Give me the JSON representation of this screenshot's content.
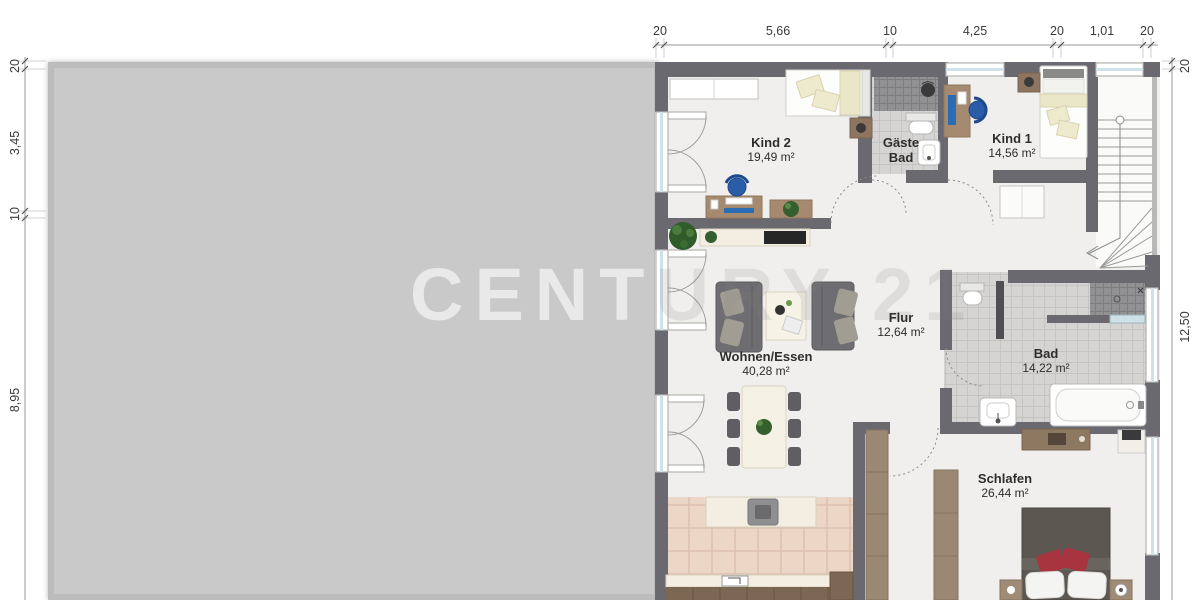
{
  "watermark": "CENTURY 21",
  "rooms": [
    {
      "id": "kind2",
      "name": "Kind 2",
      "area": "19,49 m²"
    },
    {
      "id": "gaeste-bad",
      "name": "Gäste Bad",
      "area": ""
    },
    {
      "id": "kind1",
      "name": "Kind 1",
      "area": "14,56 m²"
    },
    {
      "id": "flur",
      "name": "Flur",
      "area": "12,64 m²"
    },
    {
      "id": "wohnen-essen",
      "name": "Wohnen/Essen",
      "area": "40,28 m²"
    },
    {
      "id": "bad",
      "name": "Bad",
      "area": "14,22 m²"
    },
    {
      "id": "schlafen",
      "name": "Schlafen",
      "area": "26,44 m²"
    }
  ],
  "dimensions": {
    "top": [
      "20",
      "5,66",
      "10",
      "4,25",
      "20",
      "1,01",
      "20"
    ],
    "left": [
      "20",
      "3,45",
      "10",
      "8,95"
    ],
    "right": [
      "20",
      "12,50"
    ]
  },
  "colors": {
    "wall": "#6b6970",
    "floor": "#f0efed",
    "tile": "#d6d4d2",
    "tileDark": "#919193",
    "tileKitchen": "#ecd6c6",
    "wood": "#9b8874",
    "woodDark": "#7b6753",
    "cream": "#f3eee1",
    "sofa": "#6e6d71",
    "cushion": "#a29d93",
    "glass": "#cfe2e8",
    "chairBlue": "#2b5ca8",
    "plant": "#35602e",
    "bedDark": "#5d5752",
    "pillowRed": "#a83440",
    "dimText": "#3a3a3a",
    "dimLine": "#9a9a9a",
    "redacted": "#c9c9c9"
  }
}
